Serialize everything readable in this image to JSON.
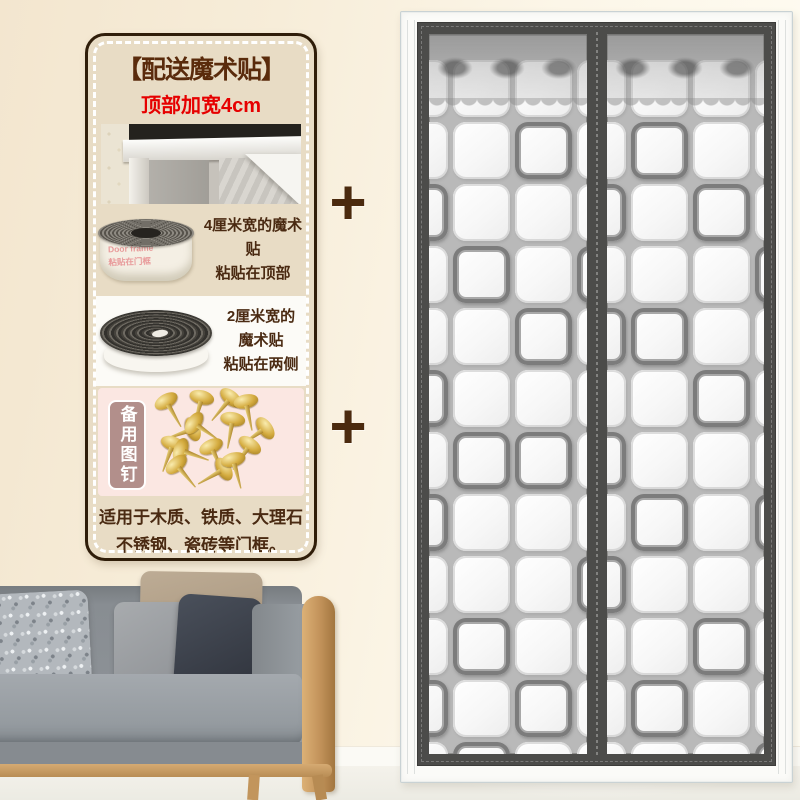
{
  "image_type": "product-promo-image",
  "badge_panel": {
    "title": "【配送魔术贴】",
    "subtitle": "顶部加宽4cm",
    "items": [
      {
        "name": "velcro-4cm",
        "line1": "4厘米宽的魔术贴",
        "line2": "粘贴在顶部",
        "print1": "Door frame",
        "print2": "粘贴在门框"
      },
      {
        "name": "velcro-2cm",
        "line1": "2厘米宽的魔术贴",
        "line2": "粘贴在两侧"
      }
    ],
    "pins_label": "备用图钉",
    "footer_line1": "适用于木质、铁质、大理石",
    "footer_line2": "不锈钢、瓷砖等门框。"
  },
  "plus_sign": "+",
  "door_curtain": {
    "description": "magnetic-screen-door-with-lace-top-and-quilted-square-pattern",
    "grid": {
      "rows": 12,
      "cols": 4
    },
    "left_panel_dark_cells": [
      [
        1,
        2
      ],
      [
        2,
        0
      ],
      [
        3,
        1
      ],
      [
        3,
        3
      ],
      [
        4,
        2
      ],
      [
        5,
        0
      ],
      [
        6,
        1
      ],
      [
        6,
        2
      ],
      [
        7,
        0
      ],
      [
        8,
        3
      ],
      [
        9,
        1
      ],
      [
        10,
        0
      ],
      [
        10,
        2
      ],
      [
        11,
        1
      ]
    ],
    "right_panel_dark_cells": [
      [
        1,
        1
      ],
      [
        2,
        0
      ],
      [
        2,
        2
      ],
      [
        3,
        3
      ],
      [
        4,
        0
      ],
      [
        4,
        1
      ],
      [
        5,
        2
      ],
      [
        6,
        0
      ],
      [
        7,
        1
      ],
      [
        7,
        3
      ],
      [
        8,
        0
      ],
      [
        9,
        2
      ],
      [
        10,
        1
      ],
      [
        11,
        3
      ]
    ]
  },
  "icons": {
    "door_frame_photo": "door-frame-corner-photo",
    "velcro_roll_4cm": "white-velcro-roll-image",
    "velcro_roll_2cm": "black-velcro-roll-image",
    "pins_image": "gold-thumbtacks-image"
  },
  "colors": {
    "wall_left": "#f3e6cf",
    "wall_right": "#fffdf4",
    "panel_bg": "#e8dcc5",
    "panel_border": "#2f1d09",
    "title_brown": "#5a2b0c",
    "subtitle_red": "#e60000",
    "text_brown": "#4a2a12",
    "pink_section": "#fbe7e2",
    "pins_label_bg": "#b28f8b",
    "gold": "#d4ab3f",
    "curtain_frame": "#4c4c4a",
    "quilt_gap": "#b9b9b9",
    "dark_square": "#7c7c7c",
    "wood": "#c2925a",
    "sofa_gray": "#8b9095"
  }
}
